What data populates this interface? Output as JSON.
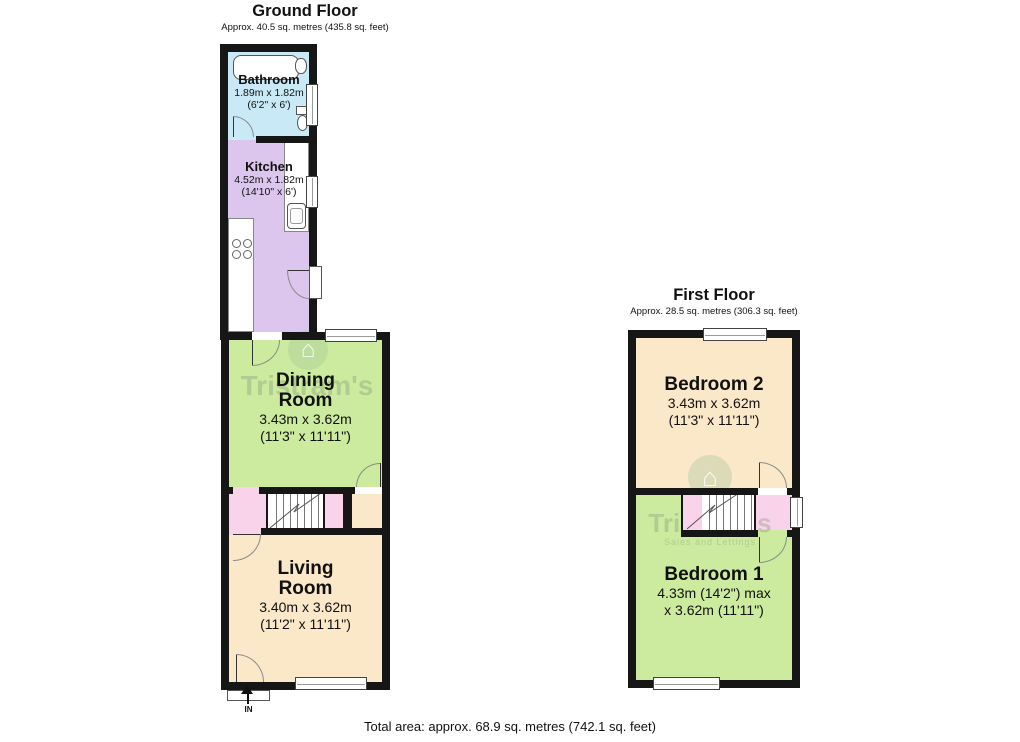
{
  "footer": {
    "total_area": "Total area: approx. 68.9 sq. metres (742.1 sq. feet)"
  },
  "watermark": {
    "name": "Tristram's",
    "tagline": "Sales and Lettings",
    "house_glyph": "⌂"
  },
  "colors": {
    "wall": "#161616",
    "bathroom_blue": "#c9e9f6",
    "kitchen_purple": "#dcc6ee",
    "green_room": "#cdeb9e",
    "cream_room": "#fae8c8",
    "hall_pink": "#f8d3ea"
  },
  "ground_floor": {
    "title": "Ground Floor",
    "subtitle": "Approx. 40.5 sq. metres (435.8 sq. feet)",
    "entrance_label": "IN",
    "rooms": {
      "bathroom": {
        "name": "Bathroom",
        "dims_metric": "1.89m x 1.82m",
        "dims_imperial": "(6'2\" x 6')"
      },
      "kitchen": {
        "name": "Kitchen",
        "dims_metric": "4.52m x 1.82m",
        "dims_imperial": "(14'10\" x 6')"
      },
      "dining_room": {
        "name_line1": "Dining",
        "name_line2": "Room",
        "dims_metric": "3.43m x 3.62m",
        "dims_imperial": "(11'3\" x 11'11\")"
      },
      "living_room": {
        "name_line1": "Living",
        "name_line2": "Room",
        "dims_metric": "3.40m x 3.62m",
        "dims_imperial": "(11'2\" x 11'11\")"
      }
    }
  },
  "first_floor": {
    "title": "First Floor",
    "subtitle": "Approx. 28.5 sq. metres (306.3 sq. feet)",
    "rooms": {
      "bedroom_2": {
        "name": "Bedroom 2",
        "dims_metric": "3.43m x 3.62m",
        "dims_imperial": "(11'3\" x 11'11\")"
      },
      "bedroom_1": {
        "name": "Bedroom 1",
        "dims_line1": "4.33m (14'2\") max",
        "dims_line2": "x 3.62m (11'11\")"
      }
    }
  }
}
